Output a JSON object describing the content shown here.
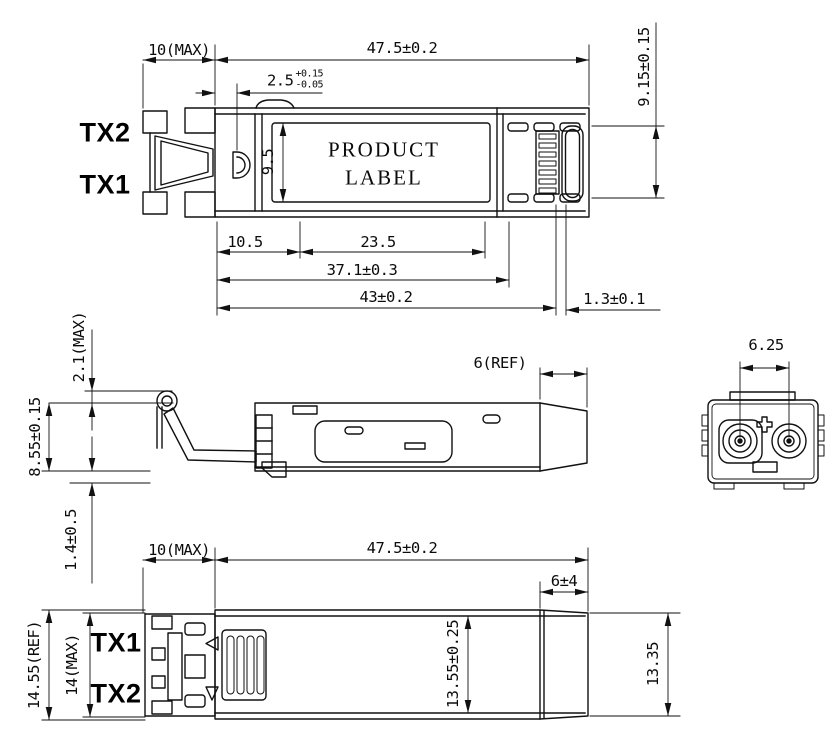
{
  "colors": {
    "line": "#111111",
    "dim_text": "#0b0b0b",
    "tx_text": "#000000",
    "background": "#ffffff"
  },
  "views": {
    "top": {
      "port_labels": {
        "tx2": "TX2",
        "tx1": "TX1"
      },
      "product_label": {
        "line1": "PRODUCT",
        "line2": "LABEL"
      },
      "dimensions": {
        "front_length": "10(MAX)",
        "body_length": "47.5±0.2",
        "latch_offset": "2.5",
        "latch_offset_tol_plus": "+0.15",
        "latch_offset_tol_minus": "-0.05",
        "connector_width": "9.15±0.15",
        "label_width": "9.5",
        "label_start": "10.5",
        "label_length": "23.5",
        "contact_length": "37.1±0.3",
        "shell_length": "43±0.2",
        "pcb_offset": "1.3±0.1"
      }
    },
    "side": {
      "dimensions": {
        "bail_height": "2.1(MAX)",
        "body_height": "8.55±0.15",
        "foot_height": "1.4±0.5",
        "tail_length": "6(REF)"
      }
    },
    "end": {
      "dimensions": {
        "ferrule_pitch": "6.25"
      }
    },
    "bottom": {
      "port_labels": {
        "tx1": "TX1",
        "tx2": "TX2"
      },
      "dimensions": {
        "front_length": "10(MAX)",
        "body_length": "47.5±0.2",
        "tail_length": "6±4",
        "overall_width": "14.55(REF)",
        "front_width": "14(MAX)",
        "body_width": "13.55±0.25",
        "tail_width": "13.35"
      }
    }
  }
}
